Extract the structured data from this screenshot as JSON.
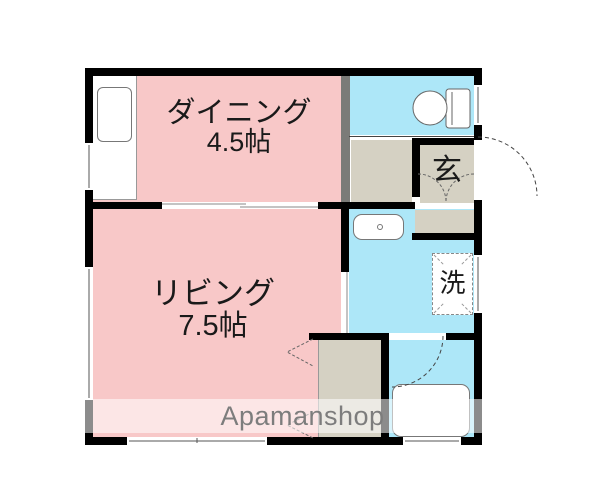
{
  "watermark": {
    "text": "Apamanshop"
  },
  "rooms": {
    "dining": {
      "name": "ダイニング",
      "size": "4.5帖"
    },
    "living": {
      "name": "リビング",
      "size": "7.5帖"
    },
    "entrance": {
      "label": "玄"
    },
    "laundry": {
      "label": "洗"
    },
    "toilet": {
      "label": ""
    },
    "bathroom": {
      "label": ""
    }
  },
  "fixtures": [
    "kitchen-counter",
    "kitchen-sink",
    "toilet-bowl",
    "washbasin",
    "washing-machine-space",
    "bathtub",
    "closet",
    "entrance-step"
  ],
  "colors": {
    "room_pink": "#F8C8C8",
    "water_cyan": "#ADE7F8",
    "entry_beige": "#D5D1C3",
    "wall_black": "#000000",
    "wall_gray": "#7B7B78",
    "watermark_gray": "#7D7D7D",
    "line_gray": "#666666"
  }
}
